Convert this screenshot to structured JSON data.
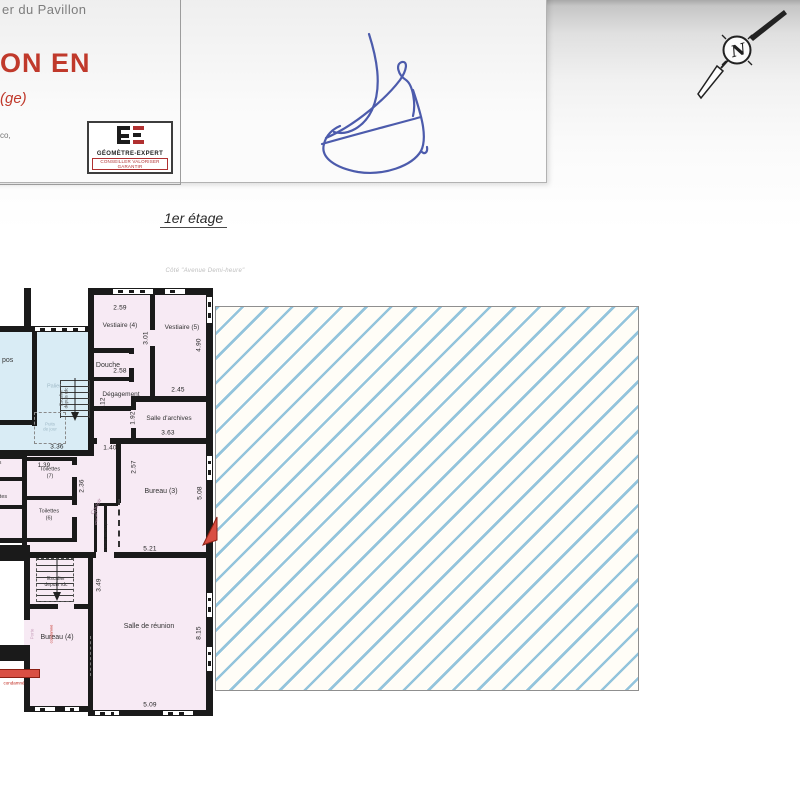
{
  "colors": {
    "title_red": "#c0392b",
    "signature_blue": "#4353a8",
    "hatch_blue": "#93c4dc",
    "room_pink": "#f7eaf4",
    "room_blue": "#d9ecf5",
    "wall_black": "#1a1a1a",
    "marker_red": "#d94f43"
  },
  "title_block": {
    "header_fragment": "er du Pavillon",
    "title_fragment": "ON EN",
    "subtitle_fragment": "(ge)",
    "small_fragment": "co,",
    "logo": {
      "name": "GÉOMÈTRE-EXPERT",
      "tagline": "CONSEILLER VALORISER GARANTIR"
    }
  },
  "annotations": {
    "floor_label": "1er étage",
    "street_note": "Côté \"Avenue Demi-heure\"",
    "north_letter": "N"
  },
  "plan": {
    "rooms": {
      "vestiaire4": "Vestiaire (4)",
      "vestiaire5": "Vestiaire (5)",
      "douche": "Douche",
      "degagement": "Dégagement",
      "archives": "Salle d'archives",
      "bureau3": "Bureau (3)",
      "bureau4": "Bureau (4)",
      "reunion": "Salle de réunion",
      "toilettes7": "Toilettes\n(7)",
      "toilettes6": "Toilettes\n(6)",
      "couloir": "Couloir"
    },
    "features": {
      "palier": "Palier",
      "puits": "Puits\nde jour",
      "stairs_up": "Escalier\ndepuis rdc",
      "stairs_down": "Escalier\ndepuis rdc",
      "armoire": "Armoire électrique",
      "placard": "Placard",
      "porte_note": "Porte",
      "condamne_note": "condamné",
      "legend_door": "condamné"
    },
    "fragments": {
      "repos": "pos",
      "left_a": "tes",
      "left_b": "lettes"
    },
    "dimensions": {
      "v4_w": "2.59",
      "v4_h": "3.01",
      "v5_h": "4.90",
      "v5_w": "2.45",
      "douche_w": "2.58",
      "degagement_h": "3.12",
      "archives_l": "1.92",
      "archives_w": "3.63",
      "opening_w": "1.40",
      "bureau3_l": "2.57",
      "bureau3_h": "5.08",
      "bureau3_w": "5.21",
      "palier_w": "3.36",
      "toilettes7_w": "1.39",
      "toilettes_h": "2.36",
      "stairs_h": "3.49",
      "reunion_h": "8.15",
      "reunion_w": "5.09"
    }
  }
}
